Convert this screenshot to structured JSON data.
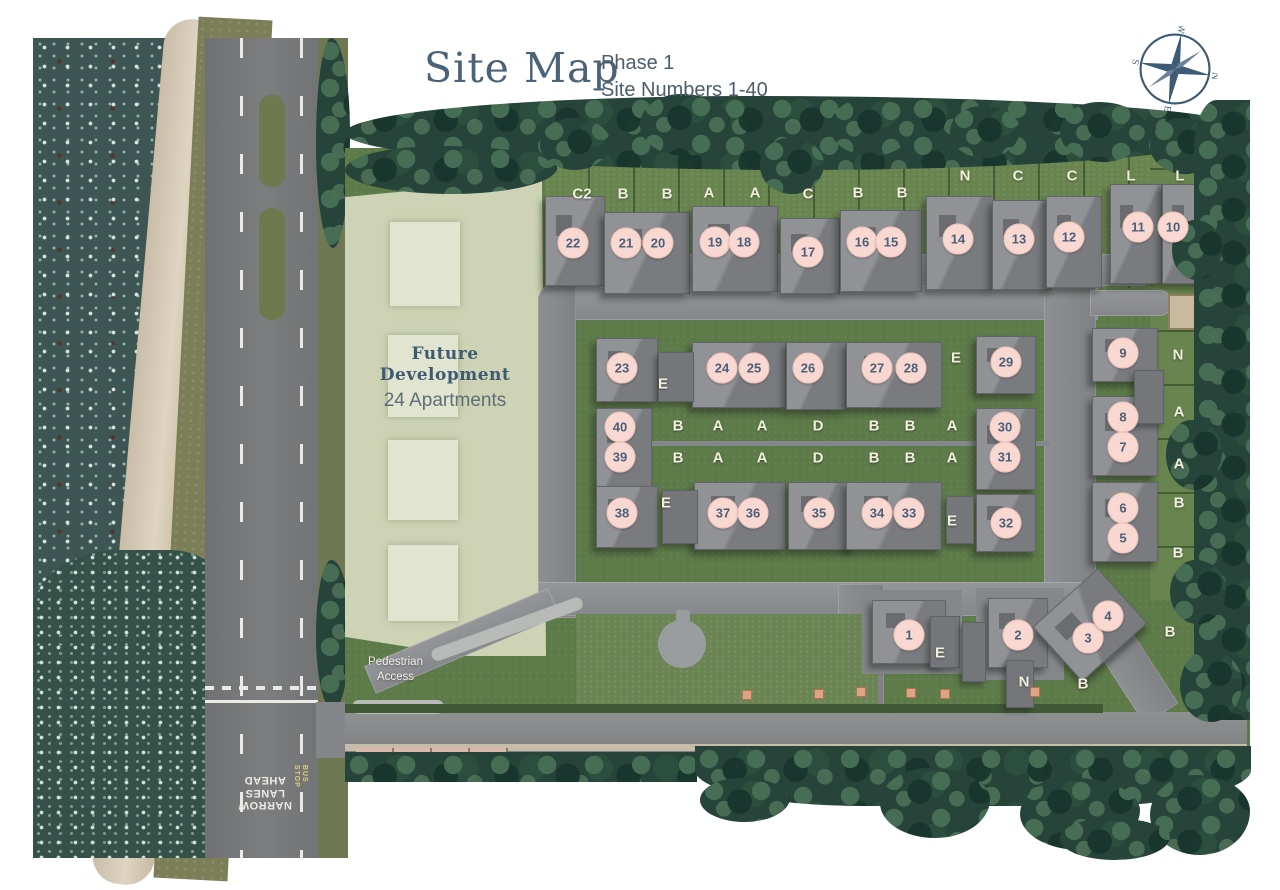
{
  "header": {
    "title": "Site Map",
    "phase": "Phase 1",
    "range": "Site Numbers 1-40"
  },
  "map": {
    "future_development": {
      "line1": "Future",
      "line2": "Development",
      "line3": "24 Apartments"
    },
    "pedestrian_access": {
      "line1": "Pedestrian",
      "line2": "Access"
    },
    "road_markings": {
      "narrow1": "NARROW",
      "narrow2": "LANES",
      "narrow3": "AHEAD",
      "bus1": "BUS",
      "bus2": "STOP"
    },
    "compass": {
      "n": "N",
      "e": "E",
      "s": "S",
      "w": "W"
    },
    "colors": {
      "plot_circle": "#f8d8d1",
      "plot_text": "#4a5f78",
      "type_label_text": "#f0f0dc",
      "title_text": "#4b6378",
      "future_area": "#cdd3b4",
      "site_green": "#5d7a49"
    },
    "plots": [
      {
        "number": "22",
        "x": 573,
        "y": 243
      },
      {
        "number": "21",
        "x": 626,
        "y": 243
      },
      {
        "number": "20",
        "x": 658,
        "y": 243
      },
      {
        "number": "19",
        "x": 715,
        "y": 242
      },
      {
        "number": "18",
        "x": 744,
        "y": 242
      },
      {
        "number": "17",
        "x": 808,
        "y": 252
      },
      {
        "number": "16",
        "x": 862,
        "y": 242
      },
      {
        "number": "15",
        "x": 891,
        "y": 242
      },
      {
        "number": "14",
        "x": 958,
        "y": 239
      },
      {
        "number": "13",
        "x": 1019,
        "y": 239
      },
      {
        "number": "12",
        "x": 1069,
        "y": 237
      },
      {
        "number": "11",
        "x": 1138,
        "y": 227
      },
      {
        "number": "10",
        "x": 1173,
        "y": 227
      },
      {
        "number": "23",
        "x": 622,
        "y": 368
      },
      {
        "number": "24",
        "x": 722,
        "y": 368
      },
      {
        "number": "25",
        "x": 754,
        "y": 368
      },
      {
        "number": "26",
        "x": 808,
        "y": 368
      },
      {
        "number": "27",
        "x": 877,
        "y": 368
      },
      {
        "number": "28",
        "x": 911,
        "y": 368
      },
      {
        "number": "29",
        "x": 1006,
        "y": 362
      },
      {
        "number": "40",
        "x": 620,
        "y": 427
      },
      {
        "number": "39",
        "x": 620,
        "y": 457
      },
      {
        "number": "30",
        "x": 1005,
        "y": 427
      },
      {
        "number": "31",
        "x": 1005,
        "y": 457
      },
      {
        "number": "38",
        "x": 622,
        "y": 513
      },
      {
        "number": "37",
        "x": 723,
        "y": 513
      },
      {
        "number": "36",
        "x": 753,
        "y": 513
      },
      {
        "number": "35",
        "x": 819,
        "y": 513
      },
      {
        "number": "34",
        "x": 877,
        "y": 513
      },
      {
        "number": "33",
        "x": 909,
        "y": 513
      },
      {
        "number": "32",
        "x": 1006,
        "y": 523
      },
      {
        "number": "9",
        "x": 1123,
        "y": 353
      },
      {
        "number": "8",
        "x": 1123,
        "y": 417
      },
      {
        "number": "7",
        "x": 1123,
        "y": 447
      },
      {
        "number": "6",
        "x": 1123,
        "y": 508
      },
      {
        "number": "5",
        "x": 1123,
        "y": 538
      },
      {
        "number": "1",
        "x": 909,
        "y": 635
      },
      {
        "number": "2",
        "x": 1018,
        "y": 635
      },
      {
        "number": "3",
        "x": 1088,
        "y": 638
      },
      {
        "number": "4",
        "x": 1108,
        "y": 616
      }
    ],
    "house_type_labels": [
      {
        "label": "C2",
        "x": 582,
        "y": 194
      },
      {
        "label": "B",
        "x": 623,
        "y": 194
      },
      {
        "label": "B",
        "x": 667,
        "y": 194
      },
      {
        "label": "A",
        "x": 709,
        "y": 193
      },
      {
        "label": "A",
        "x": 755,
        "y": 193
      },
      {
        "label": "C",
        "x": 808,
        "y": 194
      },
      {
        "label": "B",
        "x": 858,
        "y": 193
      },
      {
        "label": "B",
        "x": 902,
        "y": 193
      },
      {
        "label": "N",
        "x": 965,
        "y": 176
      },
      {
        "label": "C",
        "x": 1018,
        "y": 176
      },
      {
        "label": "C",
        "x": 1072,
        "y": 176
      },
      {
        "label": "L",
        "x": 1131,
        "y": 176
      },
      {
        "label": "L",
        "x": 1180,
        "y": 176
      },
      {
        "label": "E",
        "x": 663,
        "y": 384
      },
      {
        "label": "E",
        "x": 956,
        "y": 358
      },
      {
        "label": "B",
        "x": 678,
        "y": 426
      },
      {
        "label": "A",
        "x": 718,
        "y": 426
      },
      {
        "label": "A",
        "x": 762,
        "y": 426
      },
      {
        "label": "D",
        "x": 818,
        "y": 426
      },
      {
        "label": "B",
        "x": 874,
        "y": 426
      },
      {
        "label": "B",
        "x": 910,
        "y": 426
      },
      {
        "label": "A",
        "x": 952,
        "y": 426
      },
      {
        "label": "B",
        "x": 678,
        "y": 458
      },
      {
        "label": "A",
        "x": 718,
        "y": 458
      },
      {
        "label": "A",
        "x": 762,
        "y": 458
      },
      {
        "label": "D",
        "x": 818,
        "y": 458
      },
      {
        "label": "B",
        "x": 874,
        "y": 458
      },
      {
        "label": "B",
        "x": 910,
        "y": 458
      },
      {
        "label": "A",
        "x": 952,
        "y": 458
      },
      {
        "label": "E",
        "x": 666,
        "y": 503
      },
      {
        "label": "E",
        "x": 952,
        "y": 521
      },
      {
        "label": "N",
        "x": 1178,
        "y": 355
      },
      {
        "label": "A",
        "x": 1179,
        "y": 412
      },
      {
        "label": "A",
        "x": 1179,
        "y": 464
      },
      {
        "label": "B",
        "x": 1179,
        "y": 503
      },
      {
        "label": "B",
        "x": 1178,
        "y": 553
      },
      {
        "label": "E",
        "x": 940,
        "y": 653
      },
      {
        "label": "N",
        "x": 1024,
        "y": 682
      },
      {
        "label": "B",
        "x": 1083,
        "y": 684
      },
      {
        "label": "B",
        "x": 1170,
        "y": 632
      }
    ],
    "buildings": [
      {
        "x": 545,
        "y": 196,
        "w": 58,
        "h": 88
      },
      {
        "x": 604,
        "y": 212,
        "w": 84,
        "h": 80
      },
      {
        "x": 692,
        "y": 206,
        "w": 84,
        "h": 84
      },
      {
        "x": 780,
        "y": 218,
        "w": 58,
        "h": 74
      },
      {
        "x": 840,
        "y": 210,
        "w": 80,
        "h": 80
      },
      {
        "x": 926,
        "y": 196,
        "w": 66,
        "h": 92
      },
      {
        "x": 992,
        "y": 200,
        "w": 58,
        "h": 88
      },
      {
        "x": 1046,
        "y": 196,
        "w": 54,
        "h": 90
      },
      {
        "x": 1110,
        "y": 184,
        "w": 50,
        "h": 98
      },
      {
        "x": 1162,
        "y": 184,
        "w": 48,
        "h": 98
      },
      {
        "x": 596,
        "y": 338,
        "w": 60,
        "h": 62
      },
      {
        "x": 692,
        "y": 342,
        "w": 92,
        "h": 64
      },
      {
        "x": 786,
        "y": 342,
        "w": 58,
        "h": 66
      },
      {
        "x": 846,
        "y": 342,
        "w": 94,
        "h": 64
      },
      {
        "x": 976,
        "y": 336,
        "w": 58,
        "h": 56
      },
      {
        "x": 596,
        "y": 408,
        "w": 54,
        "h": 78
      },
      {
        "x": 976,
        "y": 408,
        "w": 58,
        "h": 80
      },
      {
        "x": 596,
        "y": 486,
        "w": 60,
        "h": 60
      },
      {
        "x": 694,
        "y": 482,
        "w": 90,
        "h": 66
      },
      {
        "x": 788,
        "y": 482,
        "w": 64,
        "h": 66
      },
      {
        "x": 846,
        "y": 482,
        "w": 94,
        "h": 66
      },
      {
        "x": 976,
        "y": 494,
        "w": 58,
        "h": 56
      },
      {
        "x": 1092,
        "y": 328,
        "w": 64,
        "h": 52
      },
      {
        "x": 1092,
        "y": 396,
        "w": 64,
        "h": 78
      },
      {
        "x": 1092,
        "y": 482,
        "w": 64,
        "h": 78
      },
      {
        "x": 872,
        "y": 600,
        "w": 72,
        "h": 62
      },
      {
        "x": 988,
        "y": 598,
        "w": 58,
        "h": 68
      },
      {
        "x": 1046,
        "y": 588,
        "w": 86,
        "h": 72,
        "rot": -42
      }
    ],
    "garages": [
      {
        "x": 658,
        "y": 352,
        "w": 34,
        "h": 48
      },
      {
        "x": 662,
        "y": 490,
        "w": 34,
        "h": 52
      },
      {
        "x": 946,
        "y": 496,
        "w": 26,
        "h": 46
      },
      {
        "x": 1134,
        "y": 370,
        "w": 28,
        "h": 52
      },
      {
        "x": 930,
        "y": 616,
        "w": 28,
        "h": 50
      },
      {
        "x": 1006,
        "y": 660,
        "w": 26,
        "h": 46
      },
      {
        "x": 962,
        "y": 622,
        "w": 22,
        "h": 58
      }
    ],
    "future_blocks": [
      {
        "x": 390,
        "y": 222,
        "w": 70,
        "h": 84
      },
      {
        "x": 388,
        "y": 335,
        "w": 70,
        "h": 82
      },
      {
        "x": 388,
        "y": 440,
        "w": 70,
        "h": 80
      },
      {
        "x": 388,
        "y": 545,
        "w": 70,
        "h": 76
      }
    ]
  }
}
